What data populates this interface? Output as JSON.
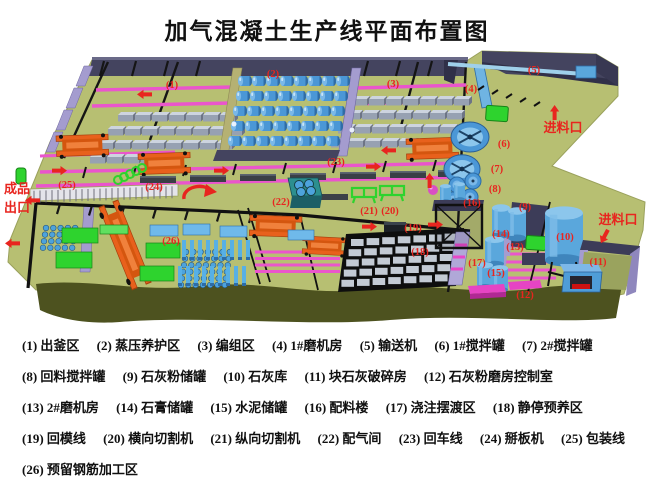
{
  "title": "加气混凝土生产线平面布置图",
  "diagram": {
    "area_labels": [
      "(1)",
      "(2)",
      "(3)",
      "(4)",
      "(5)",
      "(6)",
      "(7)",
      "(8)",
      "(9)",
      "(10)",
      "(11)",
      "(12)",
      "(13)",
      "(14)",
      "(15)",
      "(16)",
      "(17)",
      "(18)",
      "(19)",
      "(20)",
      "(21)",
      "(22)",
      "(23)",
      "(24)",
      "(25)",
      "(26)"
    ],
    "annotations": {
      "finished_exit_line1": "成品",
      "finished_exit_line2": "出口",
      "feed_inlet_top": "进料口",
      "feed_inlet_right": "进料口"
    },
    "colors": {
      "floor": "#b7bf72",
      "wall_dark": "#44445f",
      "wall_lavender": "#a49ccf",
      "rail_pink": "#ea55cc",
      "machine_orange": "#e8611c",
      "machine_green": "#2ed32e",
      "tank_blue": "#4b97d6",
      "label_red": "#e8251f"
    }
  },
  "legend": {
    "items": [
      "(1) 出釜区",
      "(2) 蒸压养护区",
      "(3) 编组区",
      "(4) 1#磨机房",
      "(5) 输送机",
      "(6) 1#搅拌罐",
      "(7) 2#搅拌罐",
      "(8) 回料搅拌罐",
      "(9) 石灰粉储罐",
      "(10) 石灰库",
      "(11) 块石灰破碎房",
      "(12) 石灰粉磨房控制室",
      "(13) 2#磨机房",
      "(14) 石膏储罐",
      "(15) 水泥储罐",
      "(16) 配料楼",
      "(17) 浇注摆渡区",
      "(18) 静停预养区",
      "(19) 回模线",
      "(20) 横向切割机",
      "(21) 纵向切割机",
      "(22) 配气间",
      "(23) 回车线",
      "(24) 掰板机",
      "(25) 包装线",
      "(26) 预留钢筋加工区"
    ]
  }
}
